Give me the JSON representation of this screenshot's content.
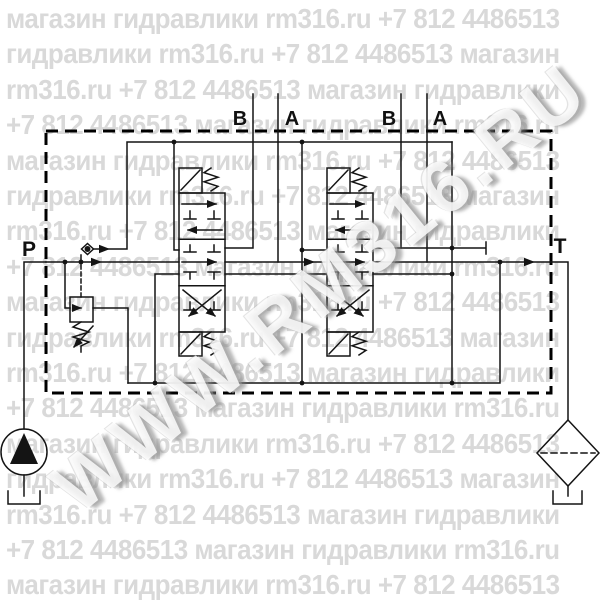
{
  "watermark": {
    "diagonal": "WWW.RM316.RU",
    "row_cycle": [
      "магазин гидравлики rm316.ru +7 812 4486513",
      "гидравлики rm316.ru +7 812 4486513 магазин",
      "rm316.ru +7 812 4486513 магазин гидравлики",
      "+7 812 4486513 магазин гидравлики rm316.ru"
    ],
    "row_count": 17,
    "row_color": "#d9d9d9"
  },
  "labels": {
    "pump_port": "P",
    "tank_port": "T",
    "valve1_port_b": "B",
    "valve1_port_a": "A",
    "valve2_port_b": "B",
    "valve2_port_a": "A"
  },
  "colors": {
    "line": "#141414",
    "background": "#ffffff"
  }
}
